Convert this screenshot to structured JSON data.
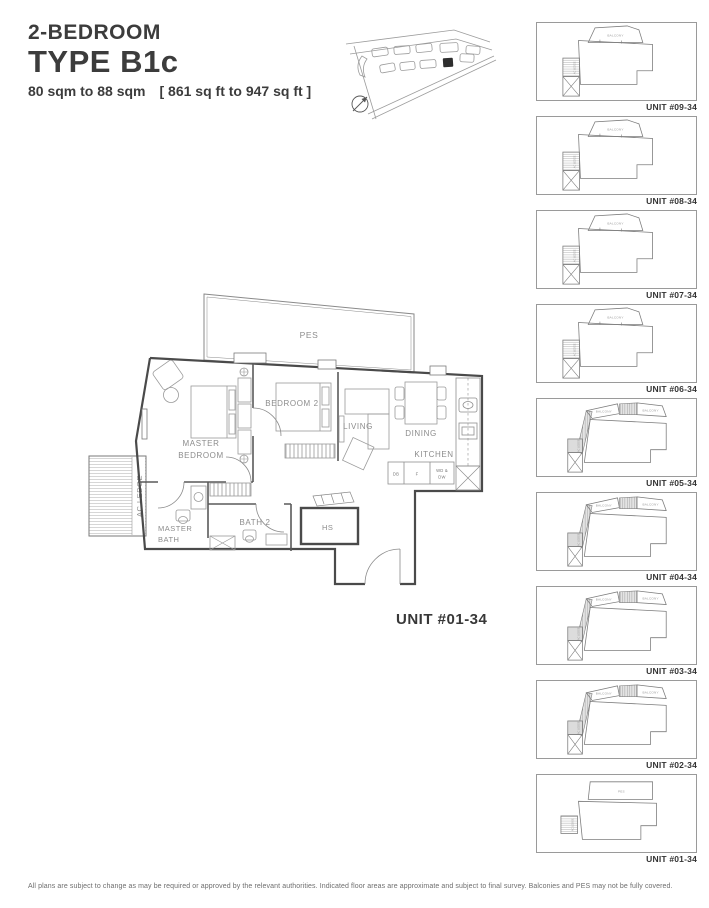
{
  "header": {
    "subtitle": "2-BEDROOM",
    "title": "TYPE B1c",
    "area_sqm": "80 sqm to 88 sqm",
    "area_sqft": "[ 861 sq ft to 947 sq ft ]"
  },
  "floorplan": {
    "unit_label": "UNIT #01-34",
    "rooms": {
      "pes": "PES",
      "master_bedroom_l1": "MASTER",
      "master_bedroom_l2": "BEDROOM",
      "bedroom2": "BEDROOM 2",
      "living": "LIVING",
      "dining": "DINING",
      "kitchen": "KITCHEN",
      "ac_ledge": "AC LEDGE",
      "master_bath_l1": "MASTER",
      "master_bath_l2": "BATH",
      "bath2": "BATH 2",
      "hs": "HS"
    },
    "appliances": {
      "db": "DB",
      "f": "F",
      "wd_l1": "WD &",
      "wd_l2": "DW"
    }
  },
  "thumb_labels": {
    "balcony": "BALCONY",
    "pes": "PES",
    "ac_ledge": "AC LEDGE"
  },
  "stack": {
    "units": [
      {
        "label": "UNIT #09-34",
        "shape": "#shape-balcony"
      },
      {
        "label": "UNIT #08-34",
        "shape": "#shape-balcony"
      },
      {
        "label": "UNIT #07-34",
        "shape": "#shape-balcony"
      },
      {
        "label": "UNIT #06-34",
        "shape": "#shape-balcony"
      },
      {
        "label": "UNIT #05-34",
        "shape": "#shape-wrap"
      },
      {
        "label": "UNIT #04-34",
        "shape": "#shape-wrap"
      },
      {
        "label": "UNIT #03-34",
        "shape": "#shape-wrap"
      },
      {
        "label": "UNIT #02-34",
        "shape": "#shape-wrap"
      },
      {
        "label": "UNIT #01-34",
        "shape": "#shape-pes"
      }
    ]
  },
  "footer": {
    "disclaimer": "All plans are subject to change as may be required or approved by the relevant authorities. Indicated floor areas are approximate and subject to final survey. Balconies and PES may not be fully covered."
  }
}
